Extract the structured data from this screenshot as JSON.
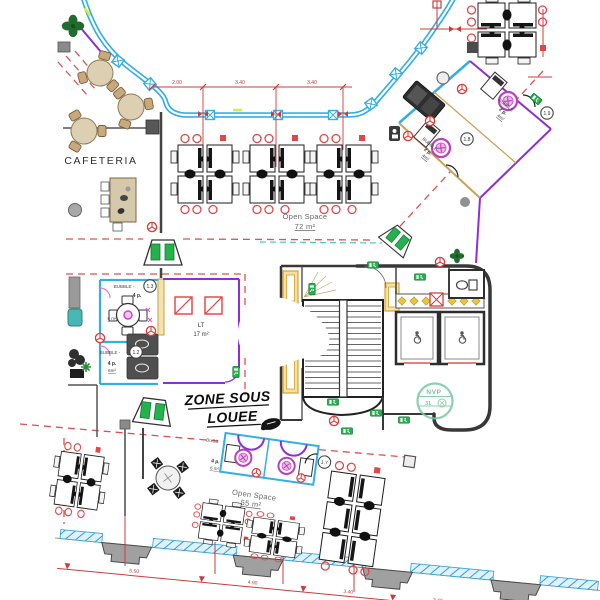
{
  "colors": {
    "curtain_wall": "#35aee5",
    "leased_boundary_purple": "#8c2fd6",
    "zone_dash_red": "#e05050",
    "exit_green": "#25b14c",
    "bubble_magenta": "#c13fc1",
    "door_yellow": "#dda727",
    "stamp_green": "#77c8a0",
    "wall_dark": "#3a3a3a",
    "wood_tan": "#cfbd9e",
    "dimension_red": "#cc3b3b"
  },
  "rooms": {
    "cafeteria": {
      "label": "CAFETERIA"
    },
    "open_space_top": {
      "label": "Open Space",
      "area": "72 m²"
    },
    "open_space_bottom": {
      "label": "Open Space",
      "area": "55 m²"
    },
    "lt": {
      "label": "LT",
      "area": "17 m²"
    },
    "zone_sous_louee": {
      "line1": "ZONE SOUS",
      "line2": "LOUEE"
    },
    "bubble_13": {
      "label": "BUBBLE -",
      "num": "1.3",
      "capacity": "4 p.",
      "area": "6 m²"
    },
    "bubble_12": {
      "label": "BUBBLE -",
      "num": "1.2",
      "capacity": "4 p.",
      "area": "6m²"
    },
    "bubble_19": {
      "label": "BUBBLE",
      "num": "1.9",
      "capacity": "2 p.",
      "area": "4m²"
    },
    "bubble_18": {
      "label": "BUBBLE -",
      "num": "1.8",
      "capacity": "2 p.",
      "area": "4m²"
    },
    "bubble_17": {
      "label": "BUBB",
      "num": "1.7",
      "capacity": "4 p.",
      "area": "6 m²"
    }
  },
  "stamp": {
    "line1": "NVP",
    "line2": "31"
  },
  "dimensions": {
    "top": [
      "2.00",
      "3.40",
      "3.40"
    ],
    "bottom": [
      "5.50",
      "4.90",
      "3.40",
      "3.40"
    ]
  }
}
